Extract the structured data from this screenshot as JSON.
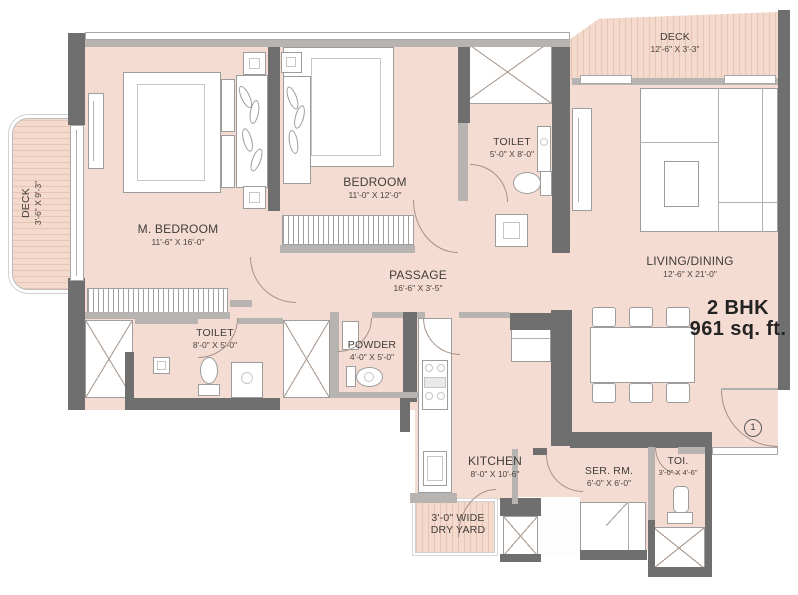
{
  "plan": {
    "title": "2 BHK",
    "area": "961 sq. ft.",
    "entrance_marker": "1"
  },
  "rooms": {
    "deck_left": {
      "name": "DECK",
      "dims": "3'-6\" X 9'-3\""
    },
    "m_bedroom": {
      "name": "M. BEDROOM",
      "dims": "11'-6\" X 16'-0\""
    },
    "bedroom": {
      "name": "BEDROOM",
      "dims": "11'-0\" X 12'-0\""
    },
    "toilet_top": {
      "name": "TOILET",
      "dims": "5'-0\" X 8'-0\""
    },
    "deck_top": {
      "name": "DECK",
      "dims": "12'-6\" X 3'-3\""
    },
    "living_dining": {
      "name": "LIVING/DINING",
      "dims": "12'-6\" X 21'-0\""
    },
    "passage": {
      "name": "PASSAGE",
      "dims": "16'-6\" X 3'-5\""
    },
    "toilet_bottom": {
      "name": "TOILET",
      "dims": "8'-0\" X 5'-0\""
    },
    "powder": {
      "name": "POWDER",
      "dims": "4'-0\" X 5'-0\""
    },
    "kitchen": {
      "name": "KITCHEN",
      "dims": "8'-0\" X 10'-6\""
    },
    "servant_room": {
      "name": "SER. RM.",
      "dims": "6'-0\" X 6'-0\""
    },
    "toi": {
      "name": "TOI.",
      "dims": "3'-0\" X 4'-6\""
    },
    "dry_yard": {
      "name": "3'-0\" WIDE",
      "dims": "DRY YARD"
    }
  },
  "colors": {
    "floor": "#f5dcd2",
    "wall_dark": "#6f6f6f",
    "wall_light": "#b7b3b0",
    "deck_stripe": "#e7c4b6",
    "text": "#403c38"
  }
}
